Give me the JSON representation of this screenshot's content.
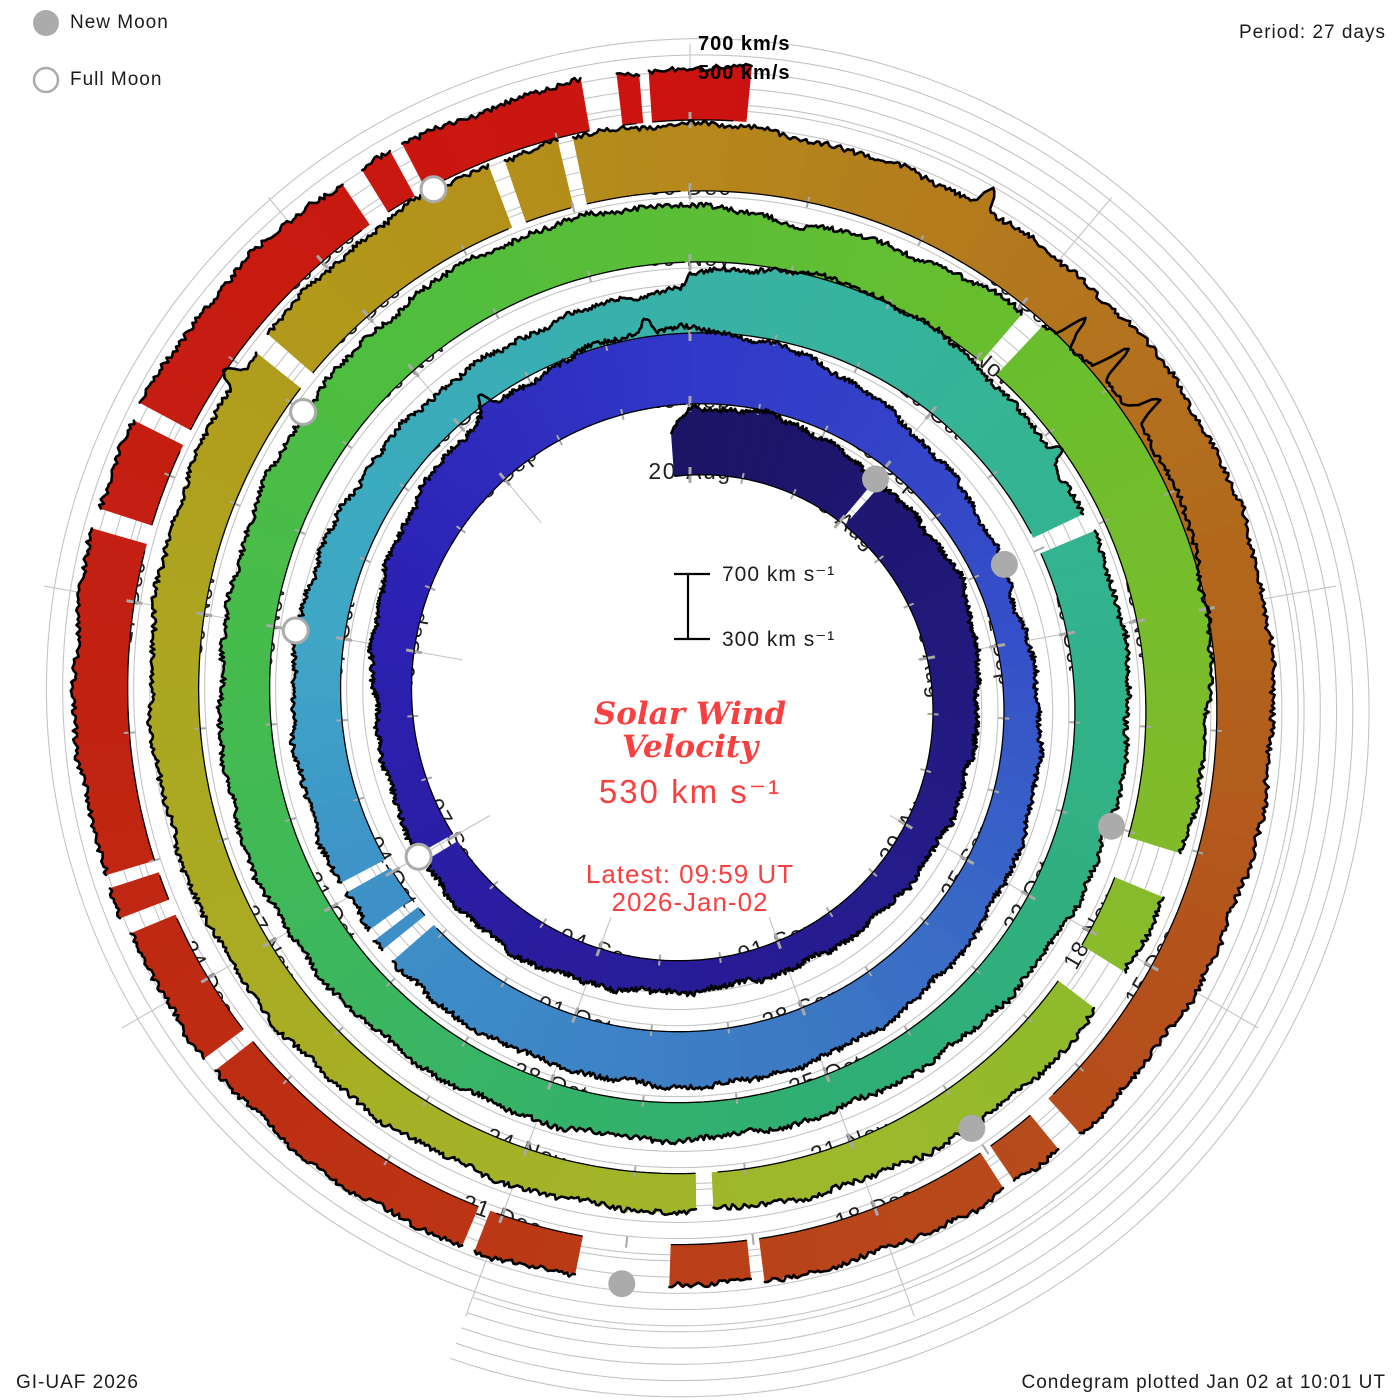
{
  "ui": {
    "legend": {
      "new_moon": "New Moon",
      "full_moon": "Full Moon"
    },
    "period_label": "Period: 27 days",
    "radial_axis_labels": {
      "v700": "700 km/s",
      "v500": "500 km/s"
    },
    "scalebar": {
      "top": "700 km s⁻¹",
      "bottom": "300 km s⁻¹"
    },
    "center": {
      "title_line1": "Solar Wind",
      "title_line2": "Velocity",
      "current_value": "530 km s⁻¹",
      "latest_line1": "Latest: 09:59 UT",
      "latest_line2": "2026-Jan-02"
    },
    "footer_left": "GI-UAF 2026",
    "footer_right": "Condegram plotted Jan 02 at 10:01 UT",
    "colors": {
      "accent_red_text": "#f84040",
      "moon_gray": "#ababab",
      "grid_gray": "#c4c4c4",
      "label_dark": "#1f1f1f",
      "outline_black": "#000000"
    }
  },
  "chart_data": {
    "type": "area",
    "variant": "polar-spiral-condegram",
    "title": "Solar Wind Velocity",
    "period_days": 27,
    "rotation_start_dates": [
      "20-Aug",
      "16-Sep",
      "13-Oct",
      "09-Nov",
      "06-Dec"
    ],
    "start_day_date": "2025-Aug-20",
    "end_date": "2026-Jan-02 09:59 UT",
    "latest_value_km_s": 530,
    "radial_axis": {
      "units": "km/s",
      "gridline_values": [
        300,
        400,
        500,
        600,
        700
      ],
      "scale_reference": {
        "low": 300,
        "high": 700
      },
      "labeled_outer_gridlines": [
        500,
        700
      ]
    },
    "series": [
      {
        "name": "solar_wind_velocity_km_s",
        "x_units": "days_since_20_Aug",
        "points": [
          [
            -0.3,
            480
          ],
          [
            0,
            600
          ],
          [
            1,
            620
          ],
          [
            2,
            590
          ],
          [
            3,
            530
          ],
          [
            4,
            540
          ],
          [
            5,
            560
          ],
          [
            6,
            500
          ],
          [
            7,
            470
          ],
          [
            9,
            430
          ],
          [
            11,
            400
          ],
          [
            13,
            380
          ],
          [
            15,
            420
          ],
          [
            16,
            455
          ],
          [
            18,
            440
          ],
          [
            20,
            420
          ],
          [
            22,
            490
          ],
          [
            24,
            570
          ],
          [
            25,
            600
          ],
          [
            26,
            660
          ],
          [
            26.9,
            670
          ],
          [
            27,
            660
          ],
          [
            28,
            610
          ],
          [
            29,
            545
          ],
          [
            30,
            470
          ],
          [
            31.5,
            410
          ],
          [
            32.5,
            375
          ],
          [
            34,
            420
          ],
          [
            36,
            470
          ],
          [
            38,
            520
          ],
          [
            40,
            540
          ],
          [
            42,
            525
          ],
          [
            43.5,
            545
          ],
          [
            45,
            515
          ],
          [
            47,
            500
          ],
          [
            48,
            490
          ],
          [
            50,
            445
          ],
          [
            52,
            425
          ],
          [
            53.9,
            470
          ],
          [
            54,
            560
          ],
          [
            55,
            640
          ],
          [
            56,
            650
          ],
          [
            57,
            610
          ],
          [
            58.5,
            540
          ],
          [
            60,
            545
          ],
          [
            61.5,
            520
          ],
          [
            63,
            480
          ],
          [
            65,
            435
          ],
          [
            67,
            420
          ],
          [
            69,
            445
          ],
          [
            71,
            485
          ],
          [
            73,
            525
          ],
          [
            75,
            495
          ],
          [
            77,
            525
          ],
          [
            79,
            560
          ],
          [
            80.9,
            560
          ],
          [
            81,
            540
          ],
          [
            82,
            490
          ],
          [
            83.5,
            560
          ],
          [
            84.5,
            640
          ],
          [
            85.5,
            690
          ],
          [
            86.5,
            660
          ],
          [
            88,
            580
          ],
          [
            89.5,
            520
          ],
          [
            91,
            490
          ],
          [
            92,
            470
          ],
          [
            94,
            430
          ],
          [
            96,
            435
          ],
          [
            98,
            455
          ],
          [
            100,
            480
          ],
          [
            102,
            505
          ],
          [
            104,
            550
          ],
          [
            106,
            605
          ],
          [
            107.9,
            620
          ],
          [
            108,
            615
          ],
          [
            109,
            575
          ],
          [
            110,
            560
          ],
          [
            111,
            545
          ],
          [
            112,
            575
          ],
          [
            113.5,
            565
          ],
          [
            115,
            540
          ],
          [
            117,
            510
          ],
          [
            118.5,
            480
          ],
          [
            120,
            465
          ],
          [
            122,
            445
          ],
          [
            124,
            475
          ],
          [
            126,
            495
          ],
          [
            128,
            525
          ],
          [
            130,
            545
          ],
          [
            132,
            520
          ],
          [
            133.5,
            495
          ],
          [
            134.6,
            515
          ],
          [
            135.416,
            530
          ]
        ]
      }
    ],
    "data_gaps_days": [
      [
        3.0,
        3.12
      ],
      [
        17.9,
        18.04
      ],
      [
        44.15,
        44.32
      ],
      [
        44.45,
        44.58
      ],
      [
        45.05,
        45.18
      ],
      [
        58.85,
        59.05
      ],
      [
        84.05,
        84.25
      ],
      [
        89.05,
        89.45
      ],
      [
        90.15,
        90.55
      ],
      [
        94.3,
        94.45
      ],
      [
        104.15,
        104.32
      ],
      [
        106.45,
        106.58
      ],
      [
        107.0,
        107.12
      ],
      [
        118.35,
        118.55
      ],
      [
        118.95,
        119.05
      ],
      [
        120.95,
        121.05
      ],
      [
        121.65,
        122.35
      ],
      [
        123.1,
        123.2
      ],
      [
        125.4,
        125.52
      ],
      [
        126.55,
        126.68
      ],
      [
        126.9,
        127.0
      ],
      [
        129.45,
        129.6
      ],
      [
        130.25,
        130.38
      ],
      [
        132.45,
        132.62
      ],
      [
        132.85,
        132.95
      ],
      [
        134.25,
        134.5
      ],
      [
        134.65,
        134.72
      ]
    ],
    "spikes": [
      [
        24.4,
        120,
        0.08
      ],
      [
        26.5,
        100,
        0.07
      ],
      [
        58.2,
        90,
        0.06
      ],
      [
        84.45,
        200,
        0.05
      ],
      [
        84.85,
        240,
        0.045
      ],
      [
        85.3,
        200,
        0.05
      ],
      [
        103.9,
        130,
        0.06
      ],
      [
        110.3,
        160,
        0.05
      ]
    ],
    "date_labels": [
      {
        "d": 0,
        "t": "20-Aug"
      },
      {
        "d": 3,
        "t": "23-Aug"
      },
      {
        "d": 6,
        "t": "26-Aug"
      },
      {
        "d": 9,
        "t": "29-Aug"
      },
      {
        "d": 12,
        "t": "01-Sep"
      },
      {
        "d": 15,
        "t": "04-Sep"
      },
      {
        "d": 18,
        "t": "07-Sep"
      },
      {
        "d": 21,
        "t": "10-Sep"
      },
      {
        "d": 24,
        "t": "13-Sep"
      },
      {
        "d": 27,
        "t": "16-Sep"
      },
      {
        "d": 30,
        "t": "19-Sep"
      },
      {
        "d": 33,
        "t": "22-Sep"
      },
      {
        "d": 36,
        "t": "25-Sep"
      },
      {
        "d": 39,
        "t": "28-Sep"
      },
      {
        "d": 42,
        "t": "01-Oct"
      },
      {
        "d": 45,
        "t": "04-Oct"
      },
      {
        "d": 48,
        "t": "07-Oct"
      },
      {
        "d": 51,
        "t": "10-Oct"
      },
      {
        "d": 54,
        "t": "13-Oct"
      },
      {
        "d": 57,
        "t": "16-Oct"
      },
      {
        "d": 60,
        "t": "19-Oct"
      },
      {
        "d": 63,
        "t": "22-Oct"
      },
      {
        "d": 66,
        "t": "25-Oct"
      },
      {
        "d": 69,
        "t": "28-Oct"
      },
      {
        "d": 72,
        "t": "31-Oct"
      },
      {
        "d": 75,
        "t": "03-Nov"
      },
      {
        "d": 78,
        "t": "06-Nov"
      },
      {
        "d": 81,
        "t": "09-Nov"
      },
      {
        "d": 84,
        "t": "12-Nov"
      },
      {
        "d": 87,
        "t": "15-Nov"
      },
      {
        "d": 90,
        "t": "18-Nov"
      },
      {
        "d": 93,
        "t": "21-Nov"
      },
      {
        "d": 96,
        "t": "24-Nov"
      },
      {
        "d": 99,
        "t": "27-Nov"
      },
      {
        "d": 102,
        "t": "30-Nov"
      },
      {
        "d": 105,
        "t": "03-Dec"
      },
      {
        "d": 108,
        "t": "06-Dec"
      },
      {
        "d": 111,
        "t": "09-Dec"
      },
      {
        "d": 114,
        "t": "12-Dec"
      },
      {
        "d": 117,
        "t": "15-Dec"
      },
      {
        "d": 120,
        "t": "18-Dec"
      },
      {
        "d": 123,
        "t": "21-Dec"
      },
      {
        "d": 126,
        "t": "24-Dec"
      },
      {
        "d": 129,
        "t": "27-Dec"
      },
      {
        "d": 132,
        "t": "30-Dec"
      }
    ],
    "moons": {
      "new_moon_days": [
        3,
        32,
        62,
        92,
        122
      ],
      "new_moon_dates": [
        "23-Aug",
        "21-Sep",
        "21-Oct",
        "20-Nov",
        "20-Dec"
      ],
      "full_moon_days": [
        18,
        48,
        77,
        106
      ],
      "full_moon_dates": [
        "07-Sep",
        "07-Oct",
        "05-Nov",
        "04-Dec"
      ]
    },
    "palette_anchors": [
      [
        0,
        "#1c1464"
      ],
      [
        10,
        "#251c8c"
      ],
      [
        17,
        "#2a1da2"
      ],
      [
        22,
        "#2c22b4"
      ],
      [
        27,
        "#3138c8"
      ],
      [
        33,
        "#3550c8"
      ],
      [
        39,
        "#3c78c4"
      ],
      [
        45,
        "#3e92c8"
      ],
      [
        48,
        "#3fa6c6"
      ],
      [
        51,
        "#3aacba"
      ],
      [
        54,
        "#38b2a6"
      ],
      [
        58,
        "#34b494"
      ],
      [
        63,
        "#30b080"
      ],
      [
        66,
        "#2fae74"
      ],
      [
        70,
        "#38b464"
      ],
      [
        74,
        "#44bb50"
      ],
      [
        78,
        "#4fbe3f"
      ],
      [
        84,
        "#68be2e"
      ],
      [
        88,
        "#7cbc2a"
      ],
      [
        93,
        "#9db92c"
      ],
      [
        98,
        "#a8ae24"
      ],
      [
        102,
        "#ada51f"
      ],
      [
        105,
        "#b2981a"
      ],
      [
        108,
        "#b5881c"
      ],
      [
        111,
        "#b3761e"
      ],
      [
        114,
        "#b2661c"
      ],
      [
        117,
        "#b4511c"
      ],
      [
        120,
        "#b8461a"
      ],
      [
        123,
        "#bb3715"
      ],
      [
        126,
        "#be2a12"
      ],
      [
        129,
        "#c22012"
      ],
      [
        132,
        "#c81a10"
      ],
      [
        135.5,
        "#cc1210"
      ]
    ]
  }
}
